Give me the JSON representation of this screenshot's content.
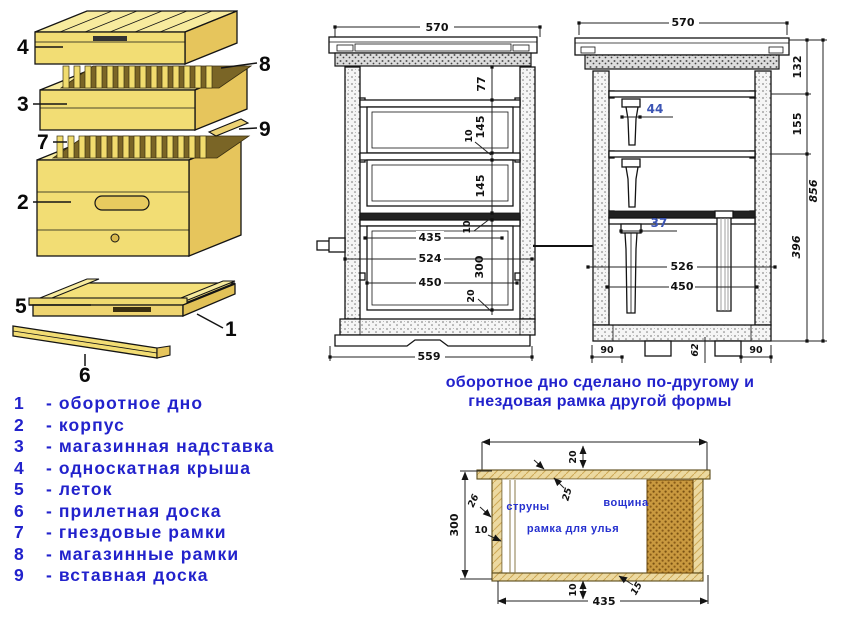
{
  "colors": {
    "text_blue": "#2222cc",
    "dim_blue": "#3c55b4",
    "line": "#141414",
    "wood": "#f2dd74"
  },
  "exploded": {
    "callouts": [
      "1",
      "2",
      "3",
      "4",
      "5",
      "6",
      "7",
      "8",
      "9"
    ]
  },
  "legend": {
    "items": [
      {
        "num": "1",
        "label": "- оборотное дно"
      },
      {
        "num": "2",
        "label": "- корпус"
      },
      {
        "num": "3",
        "label": "- магазинная надставка"
      },
      {
        "num": "4",
        "label": "- односкатная крыша"
      },
      {
        "num": "5",
        "label": "- леток"
      },
      {
        "num": "6",
        "label": "- прилетная доска"
      },
      {
        "num": "7",
        "label": "- гнездовые рамки"
      },
      {
        "num": "8",
        "label": "- магазинные рамки"
      },
      {
        "num": "9",
        "label": "- вставная доска"
      }
    ]
  },
  "caption": {
    "line1": "оборотное дно сделано по-другому и",
    "line2": "гнездовая рамка другой формы"
  },
  "front": {
    "top": "570",
    "space": "77",
    "frame1": "145",
    "gap1": "10",
    "frame2": "145",
    "gap2": "10",
    "body": "300",
    "floor": "20",
    "w_frame": "435",
    "w_outer": "524",
    "w_mid": "450",
    "bottom": "559"
  },
  "side": {
    "top": "570",
    "roof": "132",
    "super": "155",
    "body": "396",
    "total": "856",
    "top_bar": "44",
    "bar": "37",
    "w_outer": "526",
    "w_mid": "450",
    "foot_l": "90",
    "foot_r": "90",
    "floor": "62"
  },
  "frame": {
    "wires": "струны",
    "foundation": "вощина",
    "title": "рамка для улья",
    "top_gap": "20",
    "top_bar": "25",
    "side_bar": "26",
    "height": "300",
    "wire_gap": "10",
    "bottom_gap": "10",
    "width": "435",
    "bottom_bar": "15"
  }
}
